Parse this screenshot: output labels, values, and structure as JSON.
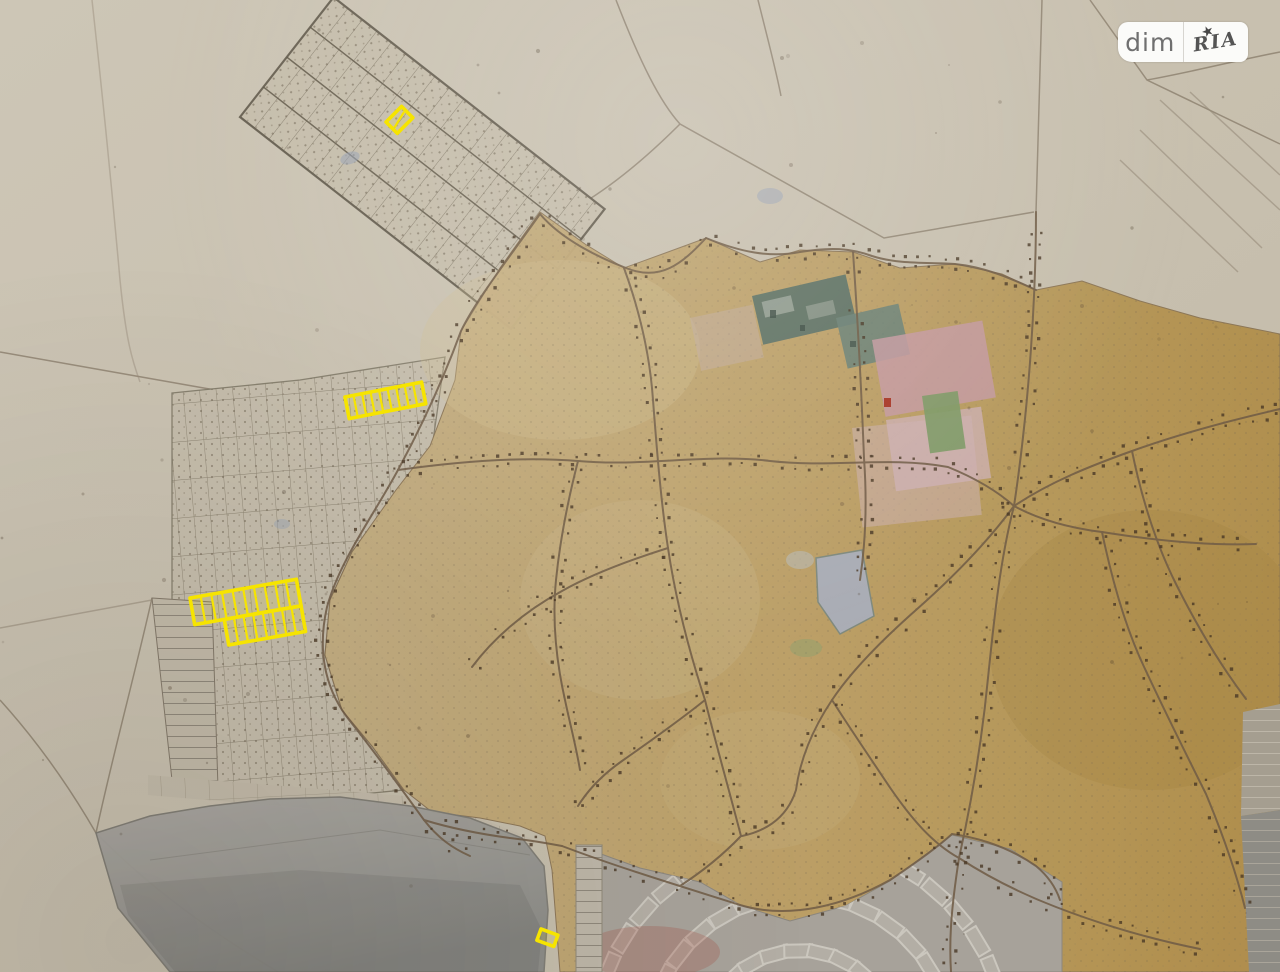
{
  "watermark": {
    "left": "dim",
    "right": "RIA",
    "star": "★"
  },
  "palette": {
    "paper": "#c8c0af",
    "paper_light": "#d3ccbc",
    "grid_area": "#c6beac",
    "orange_zone_west": "#c3ad80",
    "orange_zone_east": "#b08e4b",
    "road": "#6f5b45",
    "road_dot": "#4a3826",
    "field_line": "#8b7f6d",
    "lake": "#9b9a96",
    "radial_zone": "#a7a29a",
    "building_fill": "#b3aea5",
    "building_stroke": "#cbc7be",
    "pond": "#a9aeb9",
    "teal_block": "#5f7366",
    "pink_block": "#c49aa0",
    "green_patch": "#7e9a66",
    "red_mark": "#a83828",
    "blue_smudge": "#97a2b4",
    "highlight": "#f6e400",
    "logo_text": "#6f6f6f",
    "logo_bg": "#fbfbf9"
  },
  "highlights": [
    {
      "name": "highlight-plot-northwest",
      "tx": 386,
      "ty": 122,
      "rot": -45,
      "diag": true,
      "rows": [
        {
          "x": 0,
          "y": 0,
          "w": 22,
          "h": 16,
          "cells": 1
        }
      ]
    },
    {
      "name": "highlight-strip-west",
      "tx": 345,
      "ty": 397,
      "rot": -11,
      "rows": [
        {
          "x": 0,
          "y": 0,
          "w": 78,
          "h": 22,
          "cells": 9
        }
      ]
    },
    {
      "name": "highlight-block-west",
      "tx": 190,
      "ty": 598,
      "rot": -10,
      "rows": [
        {
          "x": 0,
          "y": 0,
          "w": 108,
          "h": 27,
          "cells": 10
        },
        {
          "x": 30,
          "y": 27,
          "w": 78,
          "h": 26,
          "cells": 8
        }
      ]
    },
    {
      "name": "highlight-plot-south",
      "tx": 541,
      "ty": 929,
      "rot": 20,
      "rows": [
        {
          "x": 0,
          "y": 0,
          "w": 18,
          "h": 12,
          "cells": 1
        }
      ]
    }
  ]
}
